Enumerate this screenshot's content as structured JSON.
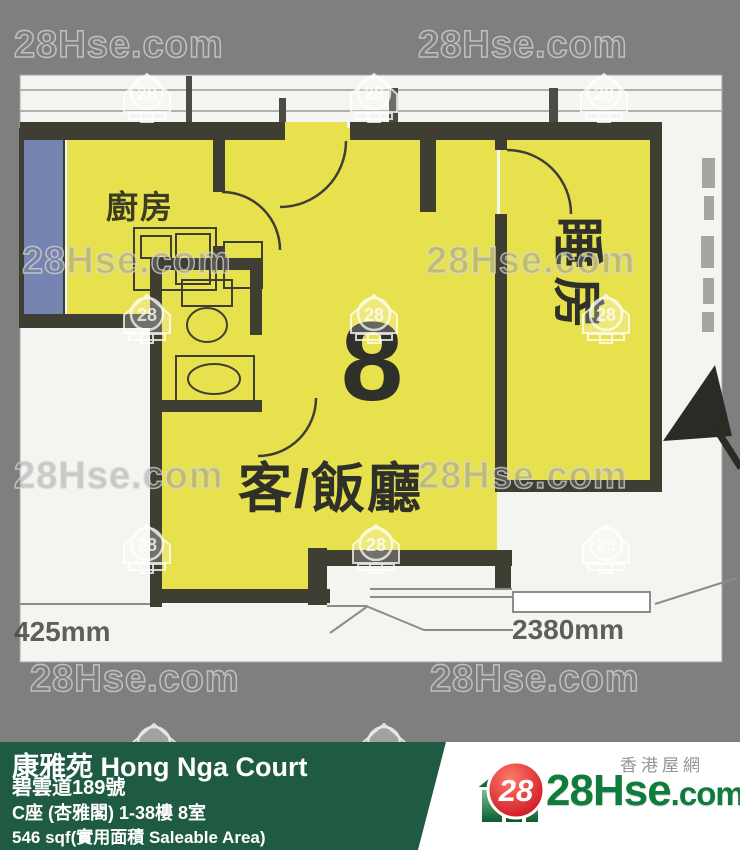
{
  "watermark": {
    "text": "28Hse.com",
    "icon_label": "28"
  },
  "floorplan": {
    "unit_number": "8",
    "labels": {
      "kitchen": "廚房",
      "living_dining": "客/飯廳",
      "bedroom": "睡房"
    },
    "dimensions": {
      "left": "425mm",
      "right": "2380mm"
    }
  },
  "info_bar": {
    "title": "康雅苑 Hong Nga Court",
    "address": "碧雲道189號",
    "block_floor_flat": "C座 (杏雅閣) 1-38樓 8室",
    "area": "546 sqf(實用面積 Saleable Area)"
  },
  "logo": {
    "badge": "28",
    "site_main": "28Hse",
    "site_suffix": ".com",
    "tagline": "香港屋網"
  },
  "colors": {
    "background": "#7f7f7f",
    "plan_paper": "#f4f4f0",
    "room_yellow": "#e8e14e",
    "wall_dark": "#3e3e33",
    "window_blue": "#7584b0",
    "bar_green": "#1f5b43",
    "logo_red": "#d31420",
    "logo_green": "#0f7c3c"
  }
}
